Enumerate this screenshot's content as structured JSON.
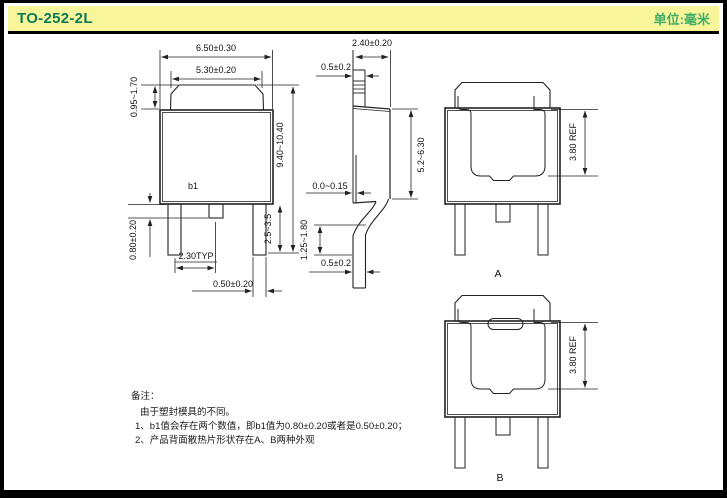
{
  "header": {
    "title": "TO-252-2L",
    "unit_label": "单位:毫米"
  },
  "colors": {
    "header_bg": "#f8f59a",
    "title": "#0a7b54",
    "unit": "#43ad68",
    "line": "#222222"
  },
  "front_view": {
    "width_outer": "6.50±0.30",
    "width_tab": "5.30±0.20",
    "tab_height": "0.95~1.70",
    "total_height": "9.40~10.40",
    "lead_length": "2.5~3.5",
    "center_lead_width_label": "b1",
    "center_lead_stickout": "0.80±0.20",
    "lead_pitch": "2.30TYP",
    "lead_width": "0.50±0.20"
  },
  "side_view": {
    "body_thickness": "2.40±0.20",
    "tab_thickness": "0.5±0.2",
    "body_height": "5.2~6.30",
    "standoff": "0.0~0.15",
    "lead_bend_height": "1.25~1.80",
    "lead_thickness": "0.5±0.2"
  },
  "back_view_a": {
    "pad_height": "3.80 REF",
    "label": "A"
  },
  "back_view_b": {
    "pad_height": "3.80 REF",
    "label": "B"
  },
  "notes": {
    "heading": "备注：",
    "intro": "由于塑封模具的不同。",
    "item1": "1、b1值会存在两个数值，即b1值为0.80±0.20或者是0.50±0.20；",
    "item2": "2、产品背面散热片形状存在A、B两种外观"
  }
}
